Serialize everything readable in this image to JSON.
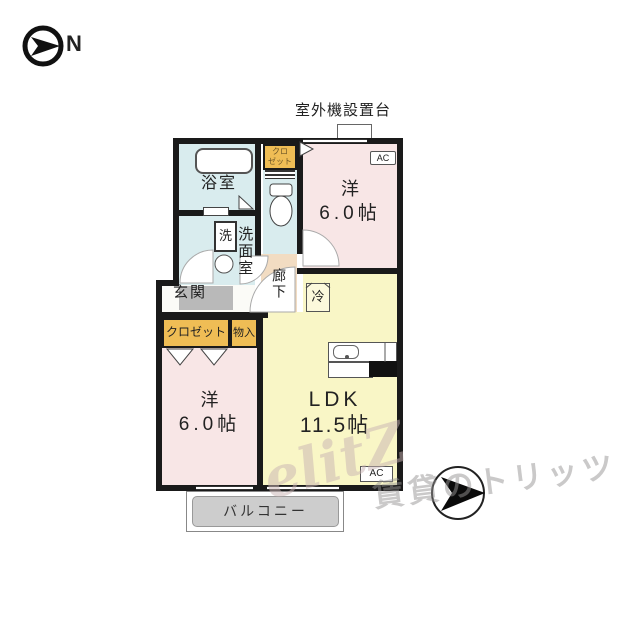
{
  "compass": {
    "label": "N"
  },
  "floor_plan": {
    "outdoor_unit_label": "室外機設置台",
    "bathroom": {
      "label": "浴室"
    },
    "upper_closet": {
      "line1": "クロ",
      "line2": "ゼット"
    },
    "washer": {
      "label": "洗"
    },
    "washroom": {
      "label": "洗面室"
    },
    "corridor": {
      "label": "廊下"
    },
    "entrance": {
      "label": "玄関"
    },
    "lower_closet": {
      "label": "クロゼット"
    },
    "storage": {
      "label": "物入"
    },
    "refrigerator": {
      "label": "冷"
    },
    "bedroom_upper": {
      "type": "洋",
      "size": "6.0帖"
    },
    "bedroom_lower": {
      "type": "洋",
      "size": "6.0帖"
    },
    "ldk": {
      "type": "LDK",
      "size": "11.5帖"
    },
    "balcony": {
      "label": "バルコニー"
    },
    "ac_upper": {
      "label": "AC"
    },
    "ac_lower": {
      "label": "AC"
    }
  },
  "watermark": {
    "logo": "elitZ",
    "brand": "賃貸のトリッツ"
  },
  "colors": {
    "wall": "#1a1a1a",
    "room-pink": "#f8e6e6",
    "room-yellow": "#f9f6c6",
    "closet-orange": "#efbd55",
    "wet-blue": "#d9ecee",
    "corridor-peach": "#f2dcc2",
    "mat-gray": "#b9b9b9",
    "balcony-gray": "#cdcdcd"
  }
}
